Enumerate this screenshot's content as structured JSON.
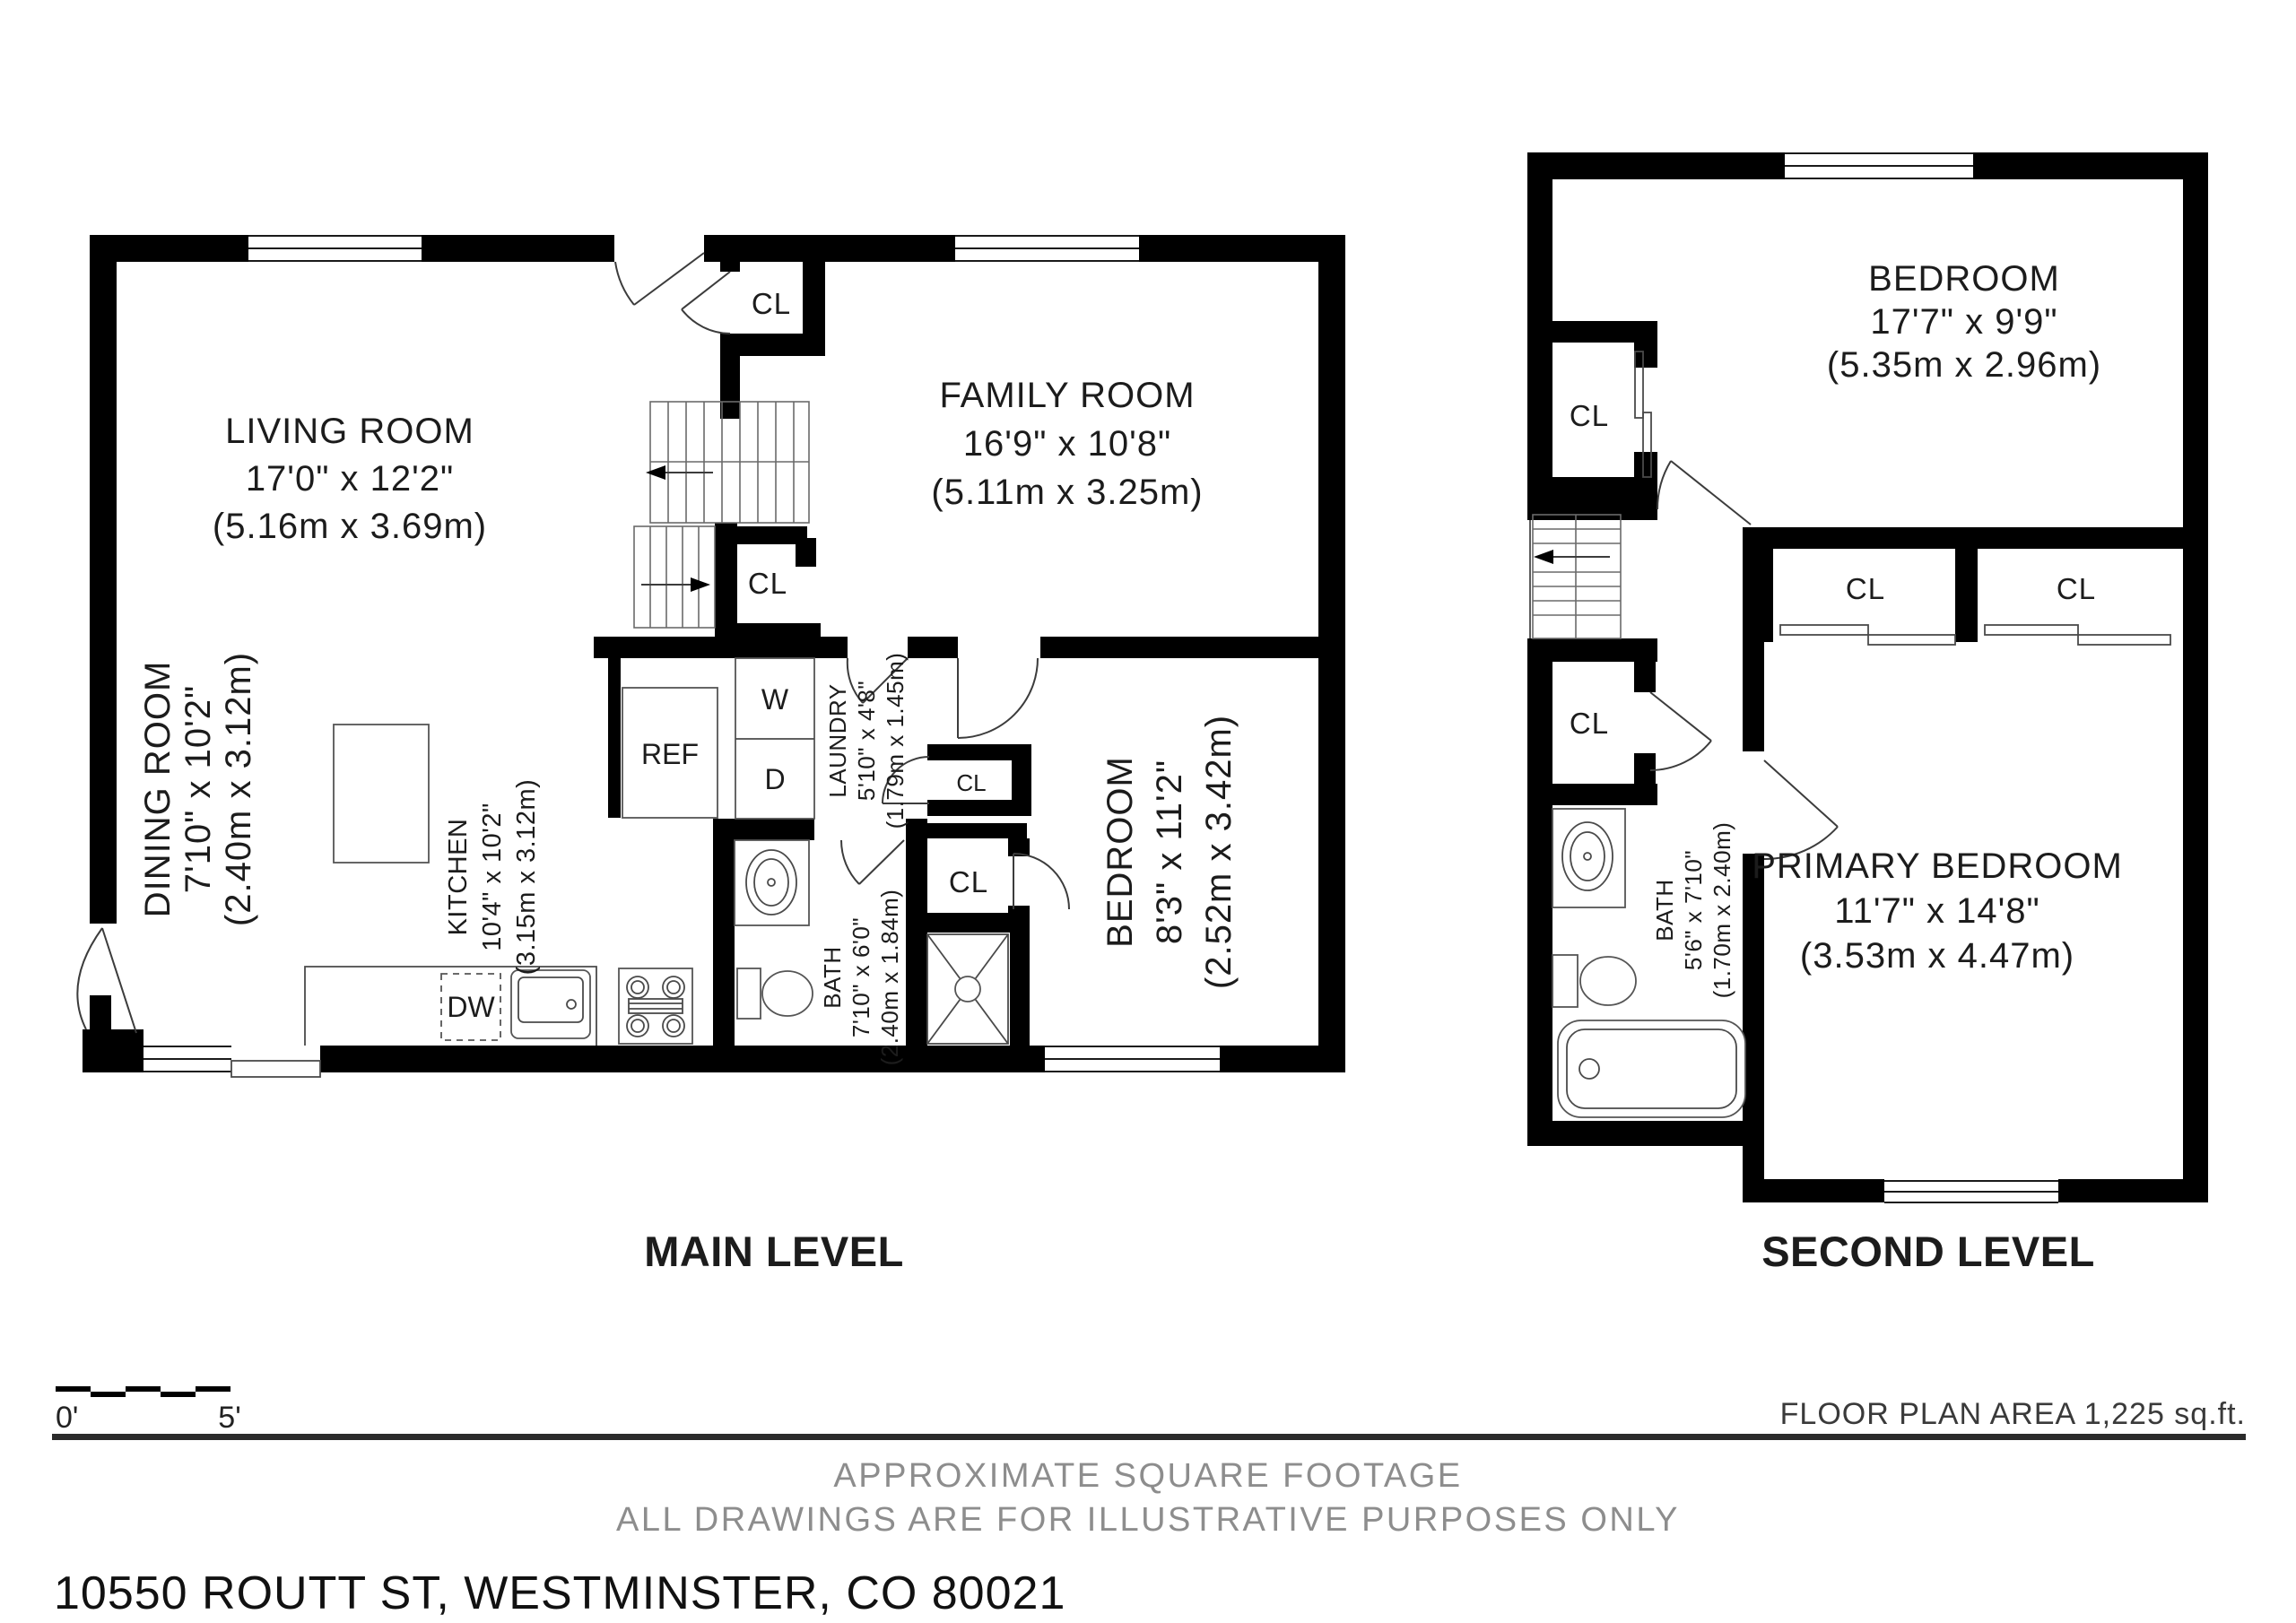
{
  "page": {
    "background": "#ffffff",
    "wall_color": "#000000",
    "muted_color": "#8d8d8d"
  },
  "main_level": {
    "title": "MAIN LEVEL",
    "rooms": {
      "living": {
        "name": "LIVING ROOM",
        "imperial": "17'0\" x 12'2\"",
        "metric": "(5.16m x 3.69m)"
      },
      "family": {
        "name": "FAMILY ROOM",
        "imperial": "16'9\" x 10'8\"",
        "metric": "(5.11m x 3.25m)"
      },
      "dining": {
        "name": "DINING ROOM",
        "imperial": "7'10\" x 10'2\"",
        "metric": "(2.40m x 3.12m)"
      },
      "kitchen": {
        "name": "KITCHEN",
        "imperial": "10'4\" x 10'2\"",
        "metric": "(3.15m x 3.12m)"
      },
      "laundry": {
        "name": "LAUNDRY",
        "imperial": "5'10\" x 4'8\"",
        "metric": "(1.79m x 1.45m)"
      },
      "bath": {
        "name": "BATH",
        "imperial": "7'10\" x 6'0\"",
        "metric": "(2.40m x 1.84m)"
      },
      "bedroom": {
        "name": "BEDROOM",
        "imperial": "8'3\" x 11'2\"",
        "metric": "(2.52m x 3.42m)"
      }
    },
    "labels": {
      "closet": "CL",
      "fridge": "REF",
      "washer": "W",
      "dryer": "D",
      "dishwasher": "DW"
    }
  },
  "second_level": {
    "title": "SECOND LEVEL",
    "rooms": {
      "bedroom": {
        "name": "BEDROOM",
        "imperial": "17'7\" x 9'9\"",
        "metric": "(5.35m x 2.96m)"
      },
      "primary": {
        "name": "PRIMARY BEDROOM",
        "imperial": "11'7\" x 14'8\"",
        "metric": "(3.53m x 4.47m)"
      },
      "bath": {
        "name": "BATH",
        "imperial": "5'6\" x 7'10\"",
        "metric": "(1.70m x 2.40m)"
      }
    },
    "labels": {
      "closet": "CL"
    }
  },
  "footer": {
    "scale_zero": "0'",
    "scale_five": "5'",
    "area_note": "FLOOR PLAN AREA 1,225 sq.ft.",
    "disclaimer_line1": "APPROXIMATE SQUARE FOOTAGE",
    "disclaimer_line2": "ALL DRAWINGS ARE FOR ILLUSTRATIVE PURPOSES ONLY",
    "address": "10550 ROUTT ST, WESTMINSTER, CO 80021"
  }
}
